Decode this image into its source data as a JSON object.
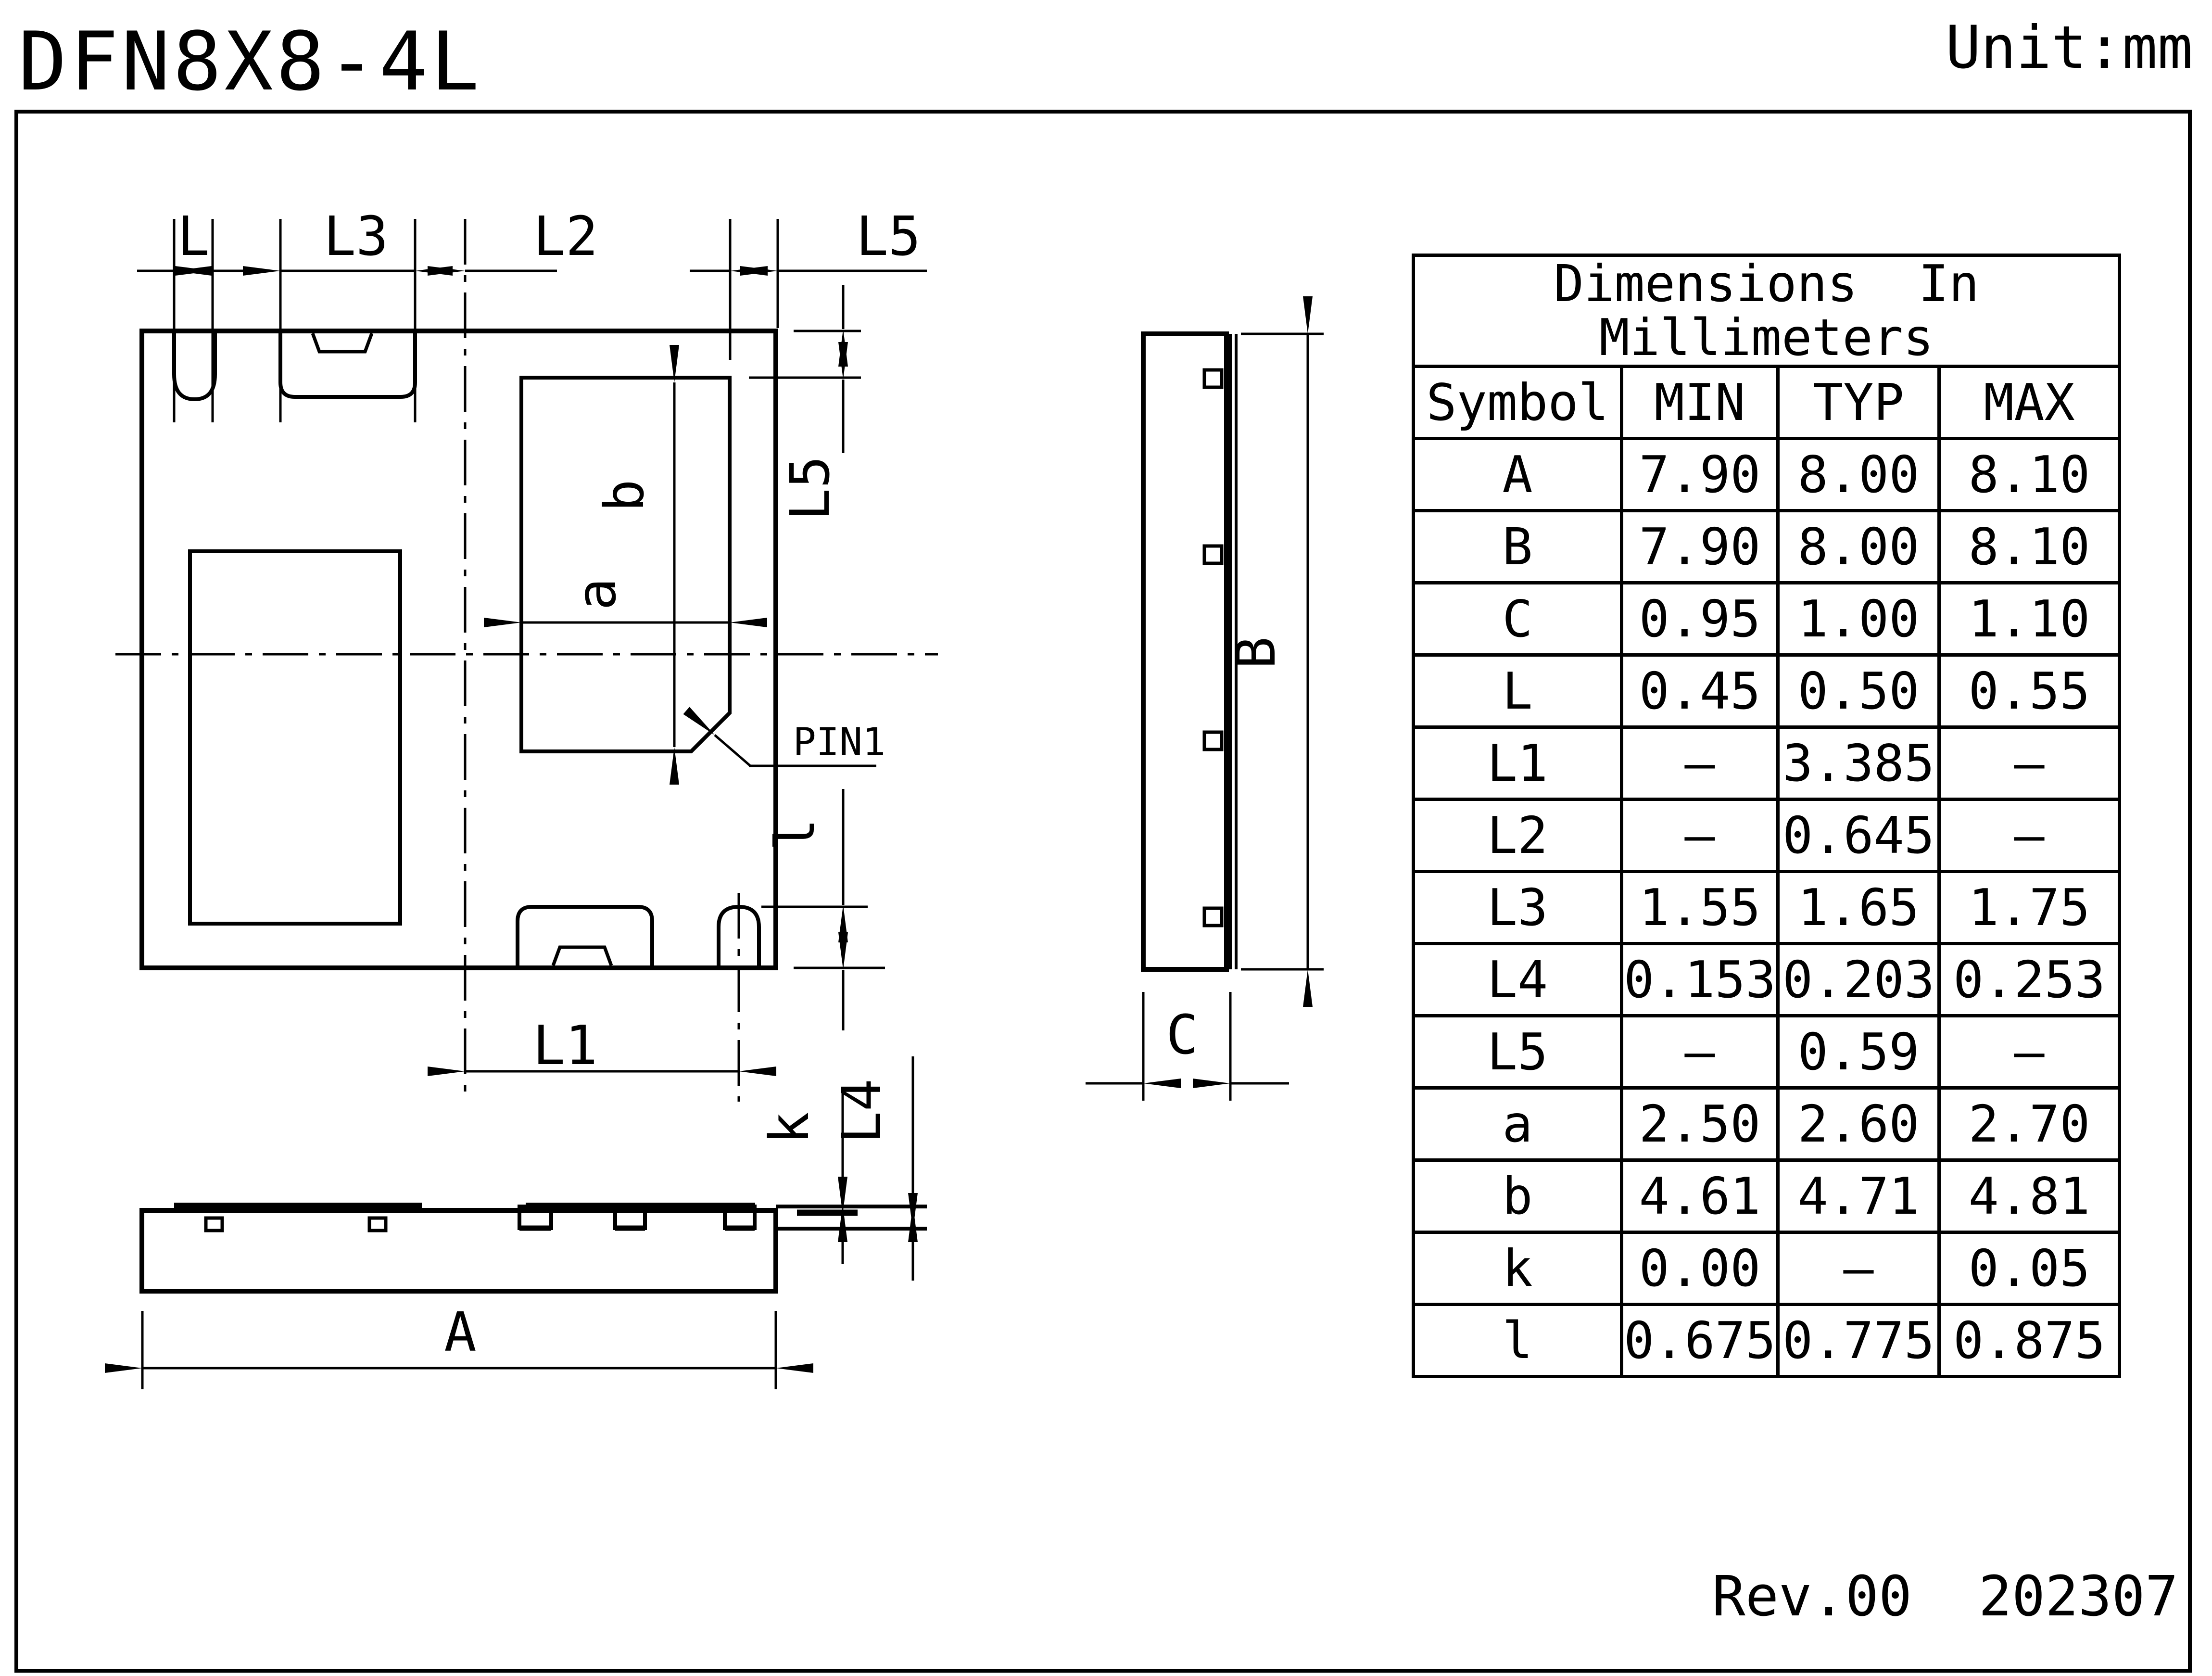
{
  "header": {
    "title": "DFN8X8-4L",
    "unit": "Unit:mm"
  },
  "footer": {
    "rev": "Rev.00",
    "date": "202307"
  },
  "table": {
    "title_line1": "Dimensions  In",
    "title_line2": "Millimeters",
    "columns": [
      "Symbol",
      "MIN",
      "TYP",
      "MAX"
    ],
    "rows": [
      {
        "symbol": "A",
        "min": "7.90",
        "typ": "8.00",
        "max": "8.10"
      },
      {
        "symbol": "B",
        "min": "7.90",
        "typ": "8.00",
        "max": "8.10"
      },
      {
        "symbol": "C",
        "min": "0.95",
        "typ": "1.00",
        "max": "1.10"
      },
      {
        "symbol": "L",
        "min": "0.45",
        "typ": "0.50",
        "max": "0.55"
      },
      {
        "symbol": "L1",
        "min": "–",
        "typ": "3.385",
        "max": "–"
      },
      {
        "symbol": "L2",
        "min": "–",
        "typ": "0.645",
        "max": "–"
      },
      {
        "symbol": "L3",
        "min": "1.55",
        "typ": "1.65",
        "max": "1.75"
      },
      {
        "symbol": "L4",
        "min": "0.153",
        "typ": "0.203",
        "max": "0.253"
      },
      {
        "symbol": "L5",
        "min": "–",
        "typ": "0.59",
        "max": "–"
      },
      {
        "symbol": "a",
        "min": "2.50",
        "typ": "2.60",
        "max": "2.70"
      },
      {
        "symbol": "b",
        "min": "4.61",
        "typ": "4.71",
        "max": "4.81"
      },
      {
        "symbol": "k",
        "min": "0.00",
        "typ": "–",
        "max": "0.05"
      },
      {
        "symbol": "l",
        "min": "0.675",
        "typ": "0.775",
        "max": "0.875"
      }
    ]
  },
  "drawing": {
    "labels": {
      "dim_L": "L",
      "dim_L3": "L3",
      "dim_L2": "L2",
      "dim_L5_top": "L5",
      "dim_L5_right": "L5",
      "dim_l": "l",
      "dim_b": "b",
      "dim_a": "a",
      "dim_L1": "L1",
      "pin1": "PIN1",
      "dim_k": "k",
      "dim_L4": "L4",
      "dim_A": "A",
      "dim_B": "B",
      "dim_C": "C"
    }
  }
}
